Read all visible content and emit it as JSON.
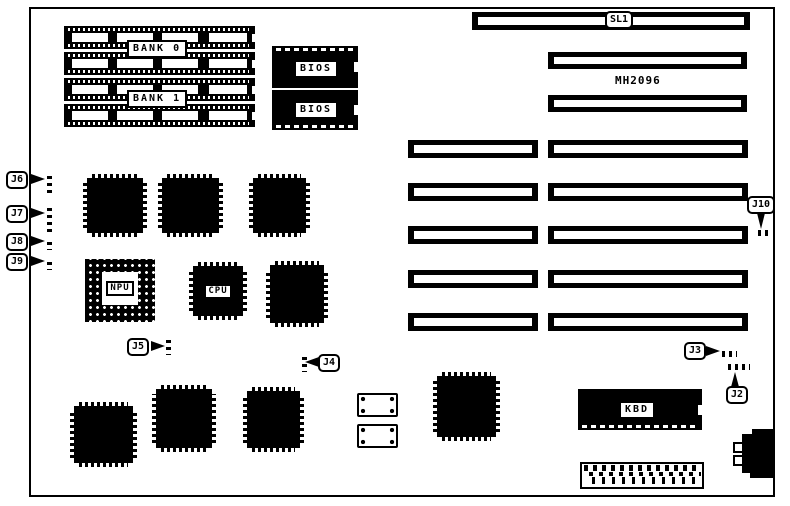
{
  "colors": {
    "ink": "#000000",
    "paper": "#ffffff"
  },
  "board": {
    "memory": {
      "bank0_label": "BANK 0",
      "bank1_label": "BANK 1"
    },
    "bios": {
      "chip1_label": "BIOS",
      "chip2_label": "BIOS"
    },
    "slots": {
      "sl1_label": "SL1",
      "mh2096_label": "MH2096"
    },
    "chips": {
      "npu_label": "NPU",
      "cpu_label": "CPU",
      "kbd_label": "KBD"
    },
    "jumpers": {
      "j2": "J2",
      "j3": "J3",
      "j4": "J4",
      "j5": "J5",
      "j6": "J6",
      "j7": "J7",
      "j8": "J8",
      "j9": "J9",
      "j10": "J10"
    }
  }
}
